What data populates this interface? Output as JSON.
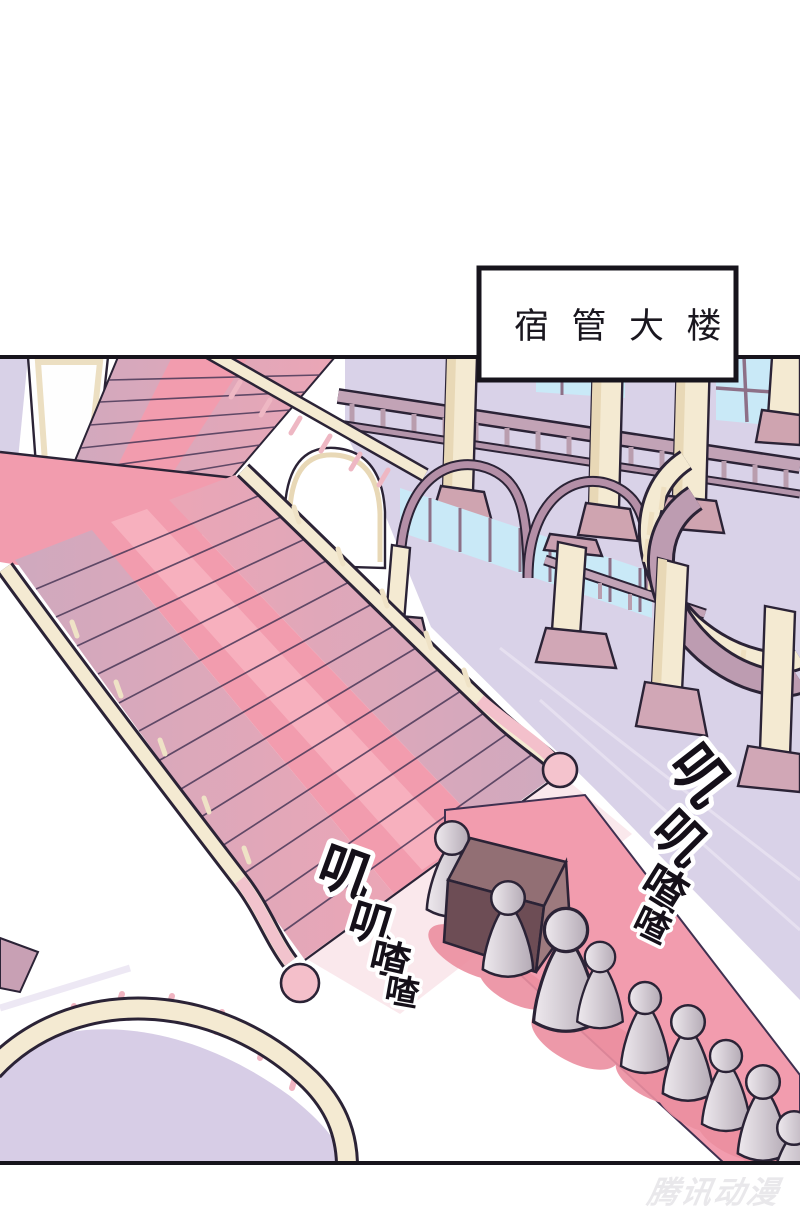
{
  "page": {
    "watermark": "腾讯动漫"
  },
  "panel": {
    "sign_text": "宿管大楼",
    "sfx_left": {
      "chars": [
        "叽",
        "叽",
        "喳",
        "喳"
      ]
    },
    "sfx_right": {
      "chars": [
        "叽",
        "叽",
        "喳",
        "喳"
      ]
    }
  },
  "colors": {
    "panel_border": "#17141c",
    "outline": "#2b2336",
    "carpet_pink": "#f29cae",
    "carpet_light": "#f7b3c0",
    "carpet_shadow": "#ec8fa0",
    "stair_side_mauve": "#cfa9be",
    "railing_cream": "#f4ead2",
    "wall_lavender": "#d9d2e8",
    "window_blue": "#c9e9f7",
    "arch_mauve": "#b48fa7",
    "balustrade_mauve": "#c2a3b6",
    "pedestal_pink": "#d1a7b6",
    "desk_dark": "#6d4d55",
    "desk_top": "#926f74",
    "desk_light": "#9d7a7e",
    "sfx_fill": "#151019",
    "sfx_stroke": "#ffffff",
    "watermark_gray": "#e9e8eb"
  }
}
